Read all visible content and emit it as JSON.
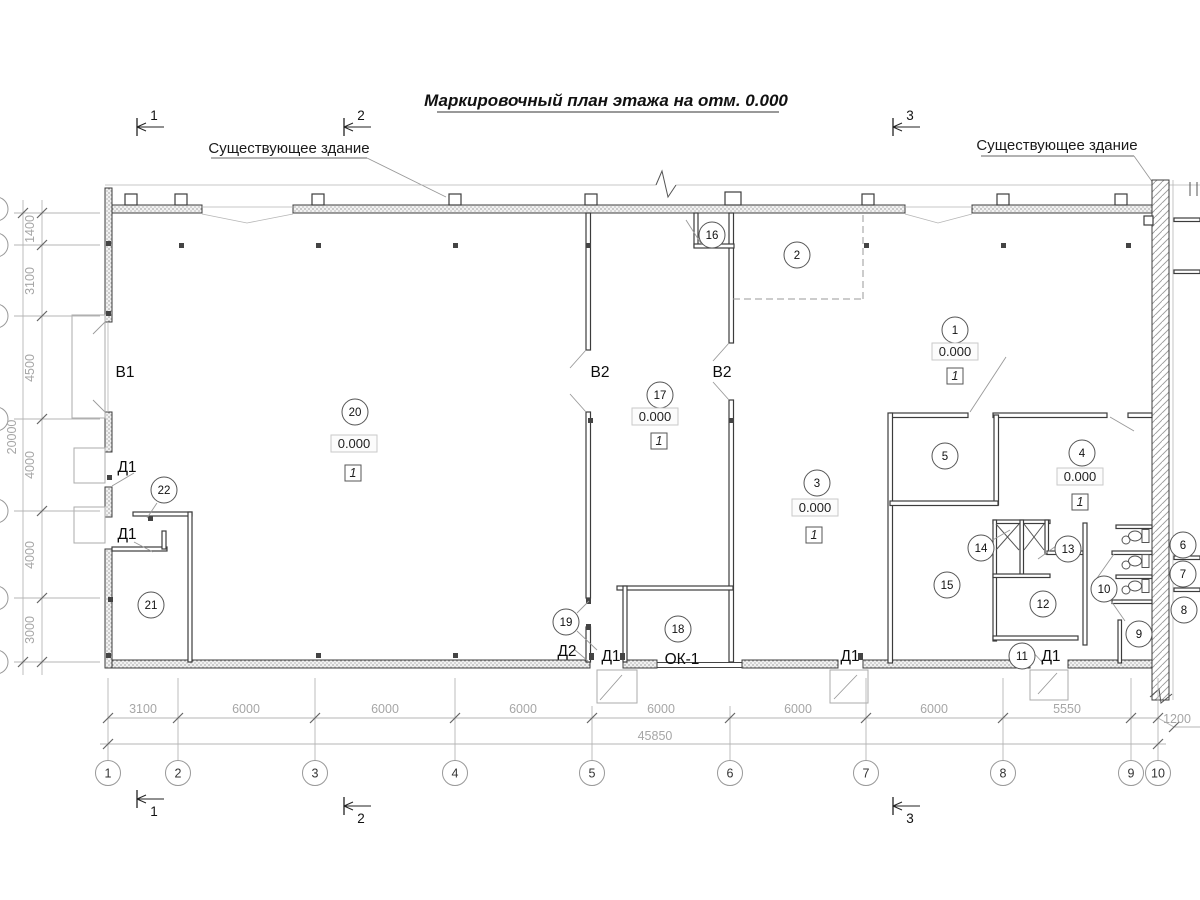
{
  "title": "Маркировочный план этажа на отм. 0.000",
  "annotations": {
    "existing_building_left": "Существующее здание",
    "existing_building_right": "Существующее здание"
  },
  "section_markers": {
    "top": [
      {
        "label": "1",
        "x": 137,
        "y": 127
      },
      {
        "label": "2",
        "x": 344,
        "y": 127
      },
      {
        "label": "3",
        "x": 893,
        "y": 127
      }
    ],
    "bottom": [
      {
        "label": "1",
        "x": 137,
        "y": 799
      },
      {
        "label": "2",
        "x": 344,
        "y": 806
      },
      {
        "label": "3",
        "x": 893,
        "y": 806
      }
    ]
  },
  "room_markers": [
    {
      "n": "1",
      "x": 955,
      "y": 330
    },
    {
      "n": "2",
      "x": 797,
      "y": 255
    },
    {
      "n": "3",
      "x": 817,
      "y": 483
    },
    {
      "n": "4",
      "x": 1082,
      "y": 453
    },
    {
      "n": "5",
      "x": 945,
      "y": 456
    },
    {
      "n": "6",
      "x": 1183,
      "y": 545
    },
    {
      "n": "7",
      "x": 1183,
      "y": 574
    },
    {
      "n": "8",
      "x": 1184,
      "y": 610
    },
    {
      "n": "9",
      "x": 1139,
      "y": 634
    },
    {
      "n": "10",
      "x": 1104,
      "y": 589
    },
    {
      "n": "11",
      "x": 1022,
      "y": 656
    },
    {
      "n": "12",
      "x": 1043,
      "y": 604
    },
    {
      "n": "13",
      "x": 1068,
      "y": 549
    },
    {
      "n": "14",
      "x": 981,
      "y": 548
    },
    {
      "n": "15",
      "x": 947,
      "y": 585
    },
    {
      "n": "16",
      "x": 712,
      "y": 235
    },
    {
      "n": "17",
      "x": 660,
      "y": 395
    },
    {
      "n": "18",
      "x": 678,
      "y": 629
    },
    {
      "n": "19",
      "x": 566,
      "y": 622
    },
    {
      "n": "20",
      "x": 355,
      "y": 412
    },
    {
      "n": "21",
      "x": 151,
      "y": 605
    },
    {
      "n": "22",
      "x": 164,
      "y": 490
    }
  ],
  "elevation_marks": [
    {
      "value": "0.000",
      "x": 354,
      "y": 448
    },
    {
      "value": "0.000",
      "x": 655,
      "y": 421
    },
    {
      "value": "0.000",
      "x": 955,
      "y": 356
    },
    {
      "value": "0.000",
      "x": 815,
      "y": 512
    },
    {
      "value": "0.000",
      "x": 1080,
      "y": 481
    }
  ],
  "floor_badges": [
    {
      "value": "1",
      "x": 353,
      "y": 477
    },
    {
      "value": "1",
      "x": 659,
      "y": 445
    },
    {
      "value": "1",
      "x": 955,
      "y": 380
    },
    {
      "value": "1",
      "x": 814,
      "y": 539
    },
    {
      "value": "1",
      "x": 1080,
      "y": 506
    }
  ],
  "opening_labels": [
    {
      "text": "В1",
      "x": 125,
      "y": 377
    },
    {
      "text": "В2",
      "x": 600,
      "y": 377
    },
    {
      "text": "В2",
      "x": 722,
      "y": 377
    },
    {
      "text": "Д1",
      "x": 127,
      "y": 472
    },
    {
      "text": "Д1",
      "x": 127,
      "y": 539
    },
    {
      "text": "Д2",
      "x": 567,
      "y": 656
    },
    {
      "text": "Д1",
      "x": 611,
      "y": 661
    },
    {
      "text": "ОК-1",
      "x": 682,
      "y": 664
    },
    {
      "text": "Д1",
      "x": 850,
      "y": 661
    },
    {
      "text": "Д1",
      "x": 1051,
      "y": 661
    }
  ],
  "grid": {
    "bubble_y": 773,
    "bubbles": [
      {
        "label": "1",
        "x": 108
      },
      {
        "label": "2",
        "x": 178
      },
      {
        "label": "3",
        "x": 315
      },
      {
        "label": "4",
        "x": 455
      },
      {
        "label": "5",
        "x": 592
      },
      {
        "label": "6",
        "x": 730
      },
      {
        "label": "7",
        "x": 866
      },
      {
        "label": "8",
        "x": 1003
      },
      {
        "label": "9",
        "x": 1131
      },
      {
        "label": "10",
        "x": 1158
      }
    ]
  },
  "dimensions": {
    "bottom_row": [
      {
        "text": "3100",
        "x": 143
      },
      {
        "text": "6000",
        "x": 246
      },
      {
        "text": "6000",
        "x": 385
      },
      {
        "text": "6000",
        "x": 523
      },
      {
        "text": "6000",
        "x": 661
      },
      {
        "text": "6000",
        "x": 798
      },
      {
        "text": "6000",
        "x": 934
      },
      {
        "text": "5550",
        "x": 1067
      }
    ],
    "bottom_offset": {
      "text": "1200",
      "x": 1177,
      "y": 723
    },
    "bottom_total": {
      "text": "45850",
      "x": 655,
      "y": 740
    },
    "left_col": [
      {
        "text": "1400",
        "y": 229
      },
      {
        "text": "3100",
        "y": 281
      },
      {
        "text": "4500",
        "y": 368
      },
      {
        "text": "4000",
        "y": 465
      },
      {
        "text": "4000",
        "y": 555
      },
      {
        "text": "3000",
        "y": 630
      }
    ],
    "left_total": {
      "text": "20000",
      "y": 437
    }
  }
}
